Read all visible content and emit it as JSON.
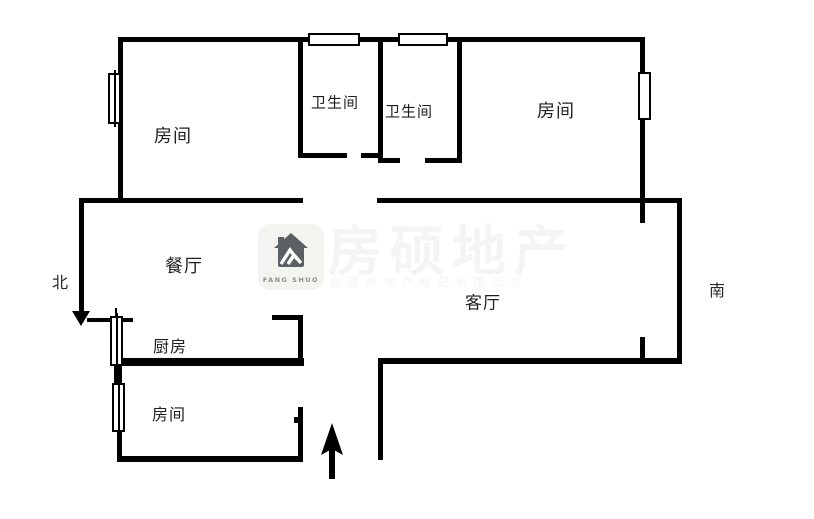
{
  "colors": {
    "wall": "#000000",
    "text": "#1f1f1f",
    "logo_bg": "#f3f3f0",
    "logo_icon": "#5b6065",
    "logo_caption": "#8f8f89"
  },
  "rooms": {
    "top_left": "房间",
    "bath_1": "卫生间",
    "bath_2": "卫生间",
    "top_right": "房间",
    "dining": "餐厅",
    "living": "客厅",
    "kitchen": "厨房",
    "bottom_left": "房间"
  },
  "compass": {
    "north": "北",
    "south": "南"
  },
  "watermark": {
    "logo_caption": "FANG SHUO",
    "brand": "房硕地产",
    "company": "房硕房地产经纪有限公司"
  }
}
